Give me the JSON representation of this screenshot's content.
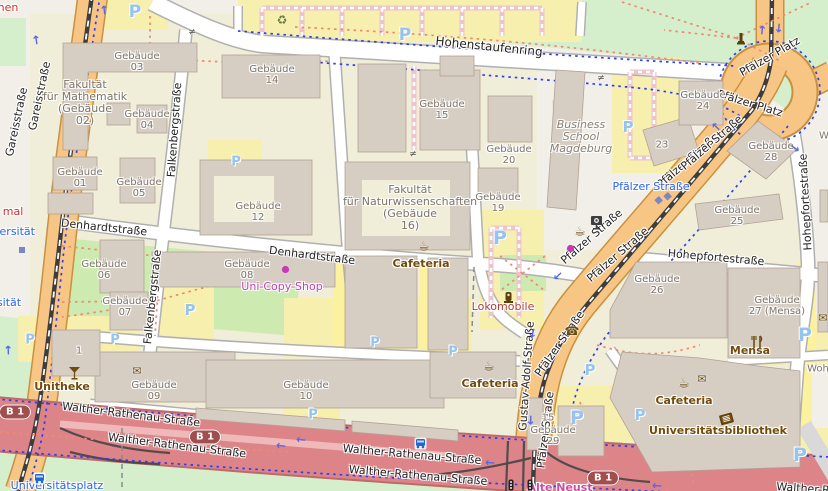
{
  "map": {
    "parking_letter": "P",
    "colors": {
      "campus": "#f0edd8",
      "park": "#d5eecb",
      "grass": "#cdebb0",
      "parking_lot": "#f6efad",
      "building": "#d6cdc3",
      "building_outline": "#b3a294",
      "road_orange": "#f7c584",
      "road_trunk_red": "#dd8489",
      "road_white": "#ffffff",
      "cycleway_blue": "#2d3ef0",
      "footpath_red": "#ef8973",
      "amenity_brown": "#734a08",
      "shop_magenta": "#bf43b0",
      "transit_blue": "#2b63ea"
    },
    "labels": [
      {
        "text": "Hohenstaufenring",
        "x": 489,
        "y": 47,
        "rot": 6,
        "cls": "street",
        "size": 12,
        "name": "street-label-hohenstaufenring"
      },
      {
        "text": "Gareisstraße",
        "x": 17,
        "y": 122,
        "rot": -78,
        "cls": "street",
        "name": "street-label-gareisstrasse"
      },
      {
        "text": "Gareisstraße",
        "x": 40,
        "y": 96,
        "rot": -78,
        "cls": "street",
        "name": "street-label-gareisstrasse"
      },
      {
        "text": "Falkenbergstraße",
        "x": 175,
        "y": 130,
        "rot": -86,
        "cls": "street",
        "name": "street-label-falkenbergstrasse"
      },
      {
        "text": "Falkenbergstraße",
        "x": 153,
        "y": 297,
        "rot": -84,
        "cls": "street",
        "name": "street-label-falkenbergstrasse"
      },
      {
        "text": "Denhardtstraße",
        "x": 104,
        "y": 228,
        "rot": 6,
        "cls": "street",
        "name": "street-label-denhardtstrasse"
      },
      {
        "text": "Denhardtstraße",
        "x": 312,
        "y": 256,
        "rot": 7,
        "cls": "street",
        "name": "street-label-denhardtstrasse"
      },
      {
        "text": "Pfälzer Straße",
        "x": 688,
        "y": 161,
        "rot": -41,
        "cls": "street",
        "name": "street-label-pfaelzer-strasse"
      },
      {
        "text": "Pfälzer Straße",
        "x": 712,
        "y": 143,
        "rot": -41,
        "cls": "street",
        "name": "street-label-pfaelzer-strasse"
      },
      {
        "text": "Pfälzer Straße",
        "x": 592,
        "y": 237,
        "rot": -41,
        "cls": "street",
        "name": "street-label-pfaelzer-strasse"
      },
      {
        "text": "Pfälzer Straße",
        "x": 618,
        "y": 255,
        "rot": -41,
        "cls": "street",
        "name": "street-label-pfaelzer-strasse"
      },
      {
        "text": "Pfälzer Straße",
        "x": 560,
        "y": 344,
        "rot": -55,
        "cls": "street",
        "name": "street-label-pfaelzer-strasse"
      },
      {
        "text": "Pfälzer Straße",
        "x": 546,
        "y": 430,
        "rot": -83,
        "cls": "street",
        "name": "street-label-pfaelzer-strasse"
      },
      {
        "text": "Gustav-Adolf-Straße",
        "x": 527,
        "y": 376,
        "rot": -86,
        "cls": "street",
        "name": "street-label-gustav-adolf-strasse"
      },
      {
        "text": "Pfälzer Platz",
        "x": 770,
        "y": 57,
        "rot": -30,
        "cls": "street",
        "name": "street-label-pfaelzer-platz"
      },
      {
        "text": "Pfälzer Platz",
        "x": 750,
        "y": 104,
        "rot": 17,
        "cls": "street",
        "name": "street-label-pfaelzer-platz"
      },
      {
        "text": "Hohepfortestraße",
        "x": 716,
        "y": 258,
        "rot": 5,
        "cls": "street",
        "name": "street-label-hohepfortestrasse"
      },
      {
        "text": "Hohepfortestraße",
        "x": 806,
        "y": 202,
        "rot": -93,
        "cls": "street",
        "name": "street-label-hohepfortestrasse"
      },
      {
        "text": "Walther-Rathenau-Straße",
        "x": 131,
        "y": 415,
        "rot": 7,
        "cls": "street",
        "name": "street-label-walther-rathenau"
      },
      {
        "text": "Walther-Rathenau-Straße",
        "x": 177,
        "y": 446,
        "rot": 7,
        "cls": "street",
        "name": "street-label-walther-rathenau"
      },
      {
        "text": "Walther-Rathenau-Straße",
        "x": 412,
        "y": 455,
        "rot": 5,
        "cls": "street",
        "name": "street-label-walther-rathenau"
      },
      {
        "text": "Walther-Rathenau-Straße",
        "x": 418,
        "y": 476,
        "rot": 5,
        "cls": "street",
        "name": "street-label-walther-rathenau"
      },
      {
        "text": "Walther-R",
        "x": 803,
        "y": 489,
        "rot": 4,
        "cls": "street",
        "name": "street-label-walther-rathenau-cut"
      },
      {
        "text": "Pfälzer Straße",
        "x": 651,
        "y": 187,
        "rot": 0,
        "cls": "transit",
        "name": "tram-stop-label-pfaelzer-strasse"
      },
      {
        "text": "Universitätsplatz",
        "x": 57,
        "y": 486,
        "rot": 0,
        "cls": "transit",
        "name": "stop-label-universitaetsplatz"
      },
      {
        "text": "versität",
        "x": 14,
        "y": 232,
        "rot": 0,
        "cls": "transit",
        "name": "stop-label-universitaet-cut"
      },
      {
        "text": "sität",
        "x": 9,
        "y": 303,
        "rot": 0,
        "cls": "transit",
        "name": "stop-label-universitaet-cut"
      },
      {
        "text": "Gebäude\n03",
        "x": 137,
        "y": 62,
        "cls": "building",
        "name": "building-label-gebaeude-03"
      },
      {
        "text": "Gebäude\n14",
        "x": 272,
        "y": 75,
        "cls": "building",
        "name": "building-label-gebaeude-14"
      },
      {
        "text": "Fakultät\nfür Mathematik\n(Gebäude\n02)",
        "x": 85,
        "y": 103,
        "cls": "faculty",
        "name": "building-label-fakultaet-mathematik"
      },
      {
        "text": "Gebäude\n04",
        "x": 147,
        "y": 120,
        "cls": "building",
        "name": "building-label-gebaeude-04"
      },
      {
        "text": "Gebäude\n15",
        "x": 442,
        "y": 110,
        "cls": "building",
        "name": "building-label-gebaeude-15"
      },
      {
        "text": "Gebäude\n24",
        "x": 703,
        "y": 101,
        "cls": "building",
        "name": "building-label-gebaeude-24"
      },
      {
        "text": "23",
        "x": 662,
        "y": 145,
        "cls": "building",
        "name": "building-label-23"
      },
      {
        "text": "Gebäude\n28",
        "x": 771,
        "y": 152,
        "cls": "building",
        "name": "building-label-gebaeude-28"
      },
      {
        "text": "Gebäude\n01",
        "x": 80,
        "y": 178,
        "cls": "building",
        "name": "building-label-gebaeude-01"
      },
      {
        "text": "Gebäude\n05",
        "x": 139,
        "y": 188,
        "cls": "building",
        "name": "building-label-gebaeude-05"
      },
      {
        "text": "Gebäude\n20",
        "x": 509,
        "y": 155,
        "cls": "building",
        "name": "building-label-gebaeude-20"
      },
      {
        "text": "Gebäude\n12",
        "x": 258,
        "y": 212,
        "cls": "building",
        "name": "building-label-gebaeude-12"
      },
      {
        "text": "Fakultät\nfür Naturwissenschaften\n(Gebäude\n16)",
        "x": 410,
        "y": 208,
        "cls": "faculty",
        "name": "building-label-fakultaet-naturwissenschaften"
      },
      {
        "text": "Gebäude\n19",
        "x": 498,
        "y": 203,
        "cls": "building",
        "name": "building-label-gebaeude-19"
      },
      {
        "text": "Business\nSchool\nMagdeburg",
        "x": 581,
        "y": 137,
        "cls": "bschool",
        "name": "building-label-business-school"
      },
      {
        "text": "Gebäude\n25",
        "x": 737,
        "y": 216,
        "cls": "building",
        "name": "building-label-gebaeude-25"
      },
      {
        "text": "Gebäude\n06",
        "x": 104,
        "y": 270,
        "cls": "building",
        "name": "building-label-gebaeude-06"
      },
      {
        "text": "Gebäude\n08",
        "x": 247,
        "y": 270,
        "cls": "building",
        "name": "building-label-gebaeude-08"
      },
      {
        "text": "Gebäude\n26",
        "x": 657,
        "y": 285,
        "cls": "building",
        "name": "building-label-gebaeude-26"
      },
      {
        "text": "Gebäude\n07",
        "x": 125,
        "y": 307,
        "cls": "building",
        "name": "building-label-gebaeude-07"
      },
      {
        "text": "Gebäude\n27 (Mensa)",
        "x": 777,
        "y": 306,
        "cls": "building",
        "name": "building-label-gebaeude-27-mensa"
      },
      {
        "text": "Gebäude\n09",
        "x": 154,
        "y": 391,
        "cls": "building",
        "name": "building-label-gebaeude-09"
      },
      {
        "text": "Gebäude\n10",
        "x": 306,
        "y": 391,
        "cls": "building",
        "name": "building-label-gebaeude-10"
      },
      {
        "text": "1",
        "x": 79,
        "y": 351,
        "cls": "building",
        "name": "building-label-1"
      },
      {
        "text": "15",
        "x": 548,
        "y": 418,
        "cls": "building",
        "name": "building-label-15"
      },
      {
        "text": "Gebäude\n29",
        "x": 553,
        "y": 436,
        "cls": "building",
        "name": "building-label-gebaeude-29"
      },
      {
        "text": "W",
        "x": 824,
        "y": 136,
        "cls": "building",
        "name": "building-label-w-cut"
      },
      {
        "text": "Woh",
        "x": 818,
        "y": 369,
        "cls": "building",
        "name": "building-label-woh-cut"
      },
      {
        "text": "Cafeteria",
        "x": 421,
        "y": 264,
        "cls": "amenity",
        "name": "amenity-label-cafeteria"
      },
      {
        "text": "Cafeteria",
        "x": 490,
        "y": 384,
        "cls": "amenity",
        "name": "amenity-label-cafeteria"
      },
      {
        "text": "Cafeteria",
        "x": 684,
        "y": 401,
        "cls": "amenity",
        "name": "amenity-label-cafeteria"
      },
      {
        "text": "Mensa",
        "x": 750,
        "y": 351,
        "cls": "amenity",
        "name": "amenity-label-mensa"
      },
      {
        "text": "Unitheke",
        "x": 62,
        "y": 387,
        "cls": "amenity",
        "name": "amenity-label-unitheke"
      },
      {
        "text": "Universitätsbibliothek",
        "x": 718,
        "y": 431,
        "cls": "amenity",
        "name": "amenity-label-universitaetsbibliothek"
      },
      {
        "text": "Uni-Copy-Shop",
        "x": 282,
        "y": 287,
        "cls": "shop",
        "name": "shop-label-uni-copy-shop"
      },
      {
        "text": "Lokomobile",
        "x": 503,
        "y": 307,
        "cls": "memorial",
        "name": "memorial-label-lokomobile"
      },
      {
        "text": "Alte Neust",
        "x": 560,
        "y": 488,
        "cls": "place",
        "name": "place-label-alte-neustadt-cut"
      },
      {
        "text": "nen",
        "x": 8,
        "y": 8,
        "cls": "cut-red",
        "name": "label-cut-nen"
      },
      {
        "text": "mal",
        "x": 13,
        "y": 212,
        "cls": "cut-red",
        "name": "label-cut-mal"
      }
    ],
    "parking_markers": [
      {
        "x": 135,
        "y": 12,
        "s": 17
      },
      {
        "x": 405,
        "y": 35,
        "s": 17
      },
      {
        "x": 628,
        "y": 127,
        "s": 15
      },
      {
        "x": 236,
        "y": 162,
        "s": 13
      },
      {
        "x": 190,
        "y": 310,
        "s": 15
      },
      {
        "x": 500,
        "y": 238,
        "s": 19
      },
      {
        "x": 30,
        "y": 340,
        "s": 13
      },
      {
        "x": 115,
        "y": 340,
        "s": 13
      },
      {
        "x": 375,
        "y": 343,
        "s": 13
      },
      {
        "x": 453,
        "y": 352,
        "s": 13
      },
      {
        "x": 805,
        "y": 335,
        "s": 19
      },
      {
        "x": 590,
        "y": 370,
        "s": 15
      },
      {
        "x": 577,
        "y": 418,
        "s": 19
      },
      {
        "x": 640,
        "y": 415,
        "s": 15
      },
      {
        "x": 800,
        "y": 455,
        "s": 19
      },
      {
        "x": 313,
        "y": 415,
        "s": 13
      }
    ],
    "route_shields": [
      {
        "text": "B 1",
        "x": 15,
        "y": 412
      },
      {
        "text": "B 1",
        "x": 205,
        "y": 437
      },
      {
        "text": "B 1",
        "x": 603,
        "y": 478
      }
    ],
    "icons": [
      {
        "kind": "cup",
        "name": "cafe-icon",
        "x": 424,
        "y": 247
      },
      {
        "kind": "cup",
        "name": "cafe-icon",
        "x": 580,
        "y": 232
      },
      {
        "kind": "cup",
        "name": "cafe-icon",
        "x": 489,
        "y": 367
      },
      {
        "kind": "cup",
        "name": "cafe-icon",
        "x": 684,
        "y": 384
      },
      {
        "kind": "envelope",
        "name": "post-box-icon",
        "x": 137,
        "y": 371
      },
      {
        "kind": "envelope",
        "name": "post-box-icon",
        "x": 702,
        "y": 379
      },
      {
        "kind": "envelope",
        "name": "post-box-icon",
        "x": 823,
        "y": 318
      },
      {
        "kind": "book",
        "name": "library-book-icon",
        "x": 718,
        "y": 412
      },
      {
        "kind": "cutlery",
        "name": "restaurant-icon",
        "x": 750,
        "y": 335
      },
      {
        "kind": "cocktail",
        "name": "bar-icon",
        "x": 68,
        "y": 366
      },
      {
        "kind": "phone",
        "name": "telephone-icon",
        "x": 572,
        "y": 331
      },
      {
        "kind": "recycle",
        "name": "recycling-icon",
        "x": 282,
        "y": 20
      },
      {
        "kind": "monument",
        "name": "monument-icon",
        "x": 736,
        "y": 32
      },
      {
        "kind": "memorial",
        "name": "memorial-icon",
        "x": 503,
        "y": 291
      },
      {
        "kind": "photobooth",
        "name": "vending-machine-icon",
        "x": 590,
        "y": 215
      },
      {
        "kind": "dot",
        "name": "shop-dot-icon",
        "x": 281,
        "y": 265
      },
      {
        "kind": "dot",
        "name": "shop-dot-icon",
        "x": 566,
        "y": 244
      },
      {
        "kind": "tram-stop",
        "name": "tram-stop-icon",
        "x": 653,
        "y": 200,
        "rot": -42
      },
      {
        "kind": "tram-stop",
        "name": "tram-stop-icon",
        "x": 662,
        "y": 196,
        "rot": -42
      },
      {
        "kind": "tram-stop",
        "name": "tram-stop-icon",
        "x": 18,
        "y": 246
      },
      {
        "kind": "bus",
        "name": "bus-stop-icon",
        "x": 33,
        "y": 472
      },
      {
        "kind": "bus",
        "name": "bus-stop-icon",
        "x": 414,
        "y": 437
      },
      {
        "kind": "traffic-light",
        "name": "traffic-signal-icon",
        "x": 508,
        "y": 479
      },
      {
        "kind": "traffic-light",
        "name": "traffic-signal-icon",
        "x": 527,
        "y": 479
      },
      {
        "kind": "barrier",
        "name": "gate-barrier-icon",
        "x": 192,
        "y": 33
      },
      {
        "kind": "barrier",
        "name": "gate-barrier-icon",
        "x": 413,
        "y": 155
      },
      {
        "kind": "barrier",
        "name": "gate-barrier-icon",
        "x": 601,
        "y": 79
      }
    ],
    "oneway_arrows": [
      {
        "x": 104,
        "y": 10,
        "rot": -97
      },
      {
        "x": 36,
        "y": 40,
        "rot": -99
      },
      {
        "x": 8,
        "y": 350,
        "rot": -93
      },
      {
        "x": 281,
        "y": 446,
        "rot": 186
      },
      {
        "x": 301,
        "y": 440,
        "rot": 186
      },
      {
        "x": 490,
        "y": 463,
        "rot": 183
      },
      {
        "x": 657,
        "y": 486,
        "rot": 184
      },
      {
        "x": 558,
        "y": 276,
        "rot": 137
      },
      {
        "x": 533,
        "y": 333,
        "rot": 105
      },
      {
        "x": 531,
        "y": 420,
        "rot": 92
      },
      {
        "x": 716,
        "y": 127,
        "rot": -137
      },
      {
        "x": 762,
        "y": 30,
        "rot": -85
      },
      {
        "x": 779,
        "y": 28,
        "rot": 95
      },
      {
        "x": 795,
        "y": 148,
        "rot": 35
      }
    ]
  }
}
